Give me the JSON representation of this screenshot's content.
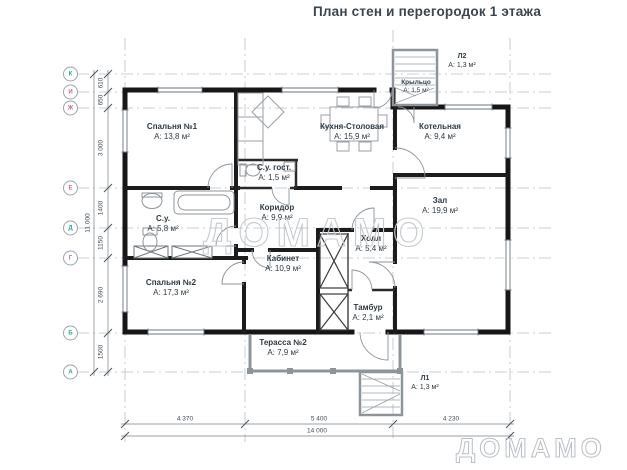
{
  "title": "План стен и перегородок 1 этажа",
  "watermark": {
    "center": "ДОМАМО",
    "corner": "ДОМАМО"
  },
  "rooms": {
    "bedroom1": {
      "name": "Спальня №1",
      "area": "А: 13,8 м²"
    },
    "kitchen": {
      "name": "Кухня-Столовая",
      "area": "А: 15,9 м²"
    },
    "boiler": {
      "name": "Котельная",
      "area": "А: 9,4 м²"
    },
    "living": {
      "name": "Зал",
      "area": "А: 19,9 м²"
    },
    "guest_wc": {
      "name": "С.у. гост.",
      "area": "А: 1,5 м²"
    },
    "corridor": {
      "name": "Коридор",
      "area": "А: 9,9 м²"
    },
    "wc": {
      "name": "С.у.",
      "area": "А: 5,8 м²"
    },
    "cabinet": {
      "name": "Кабинет",
      "area": "А: 10,9 м²"
    },
    "hall": {
      "name": "Холл",
      "area": "А: 5,4 м²"
    },
    "bedroom2": {
      "name": "Спальня №2",
      "area": "А: 17,3 м²"
    },
    "tambour": {
      "name": "Тамбур",
      "area": "А: 2,1 м²"
    },
    "terrace": {
      "name": "Терасса №2",
      "area": "А: 7,9 м²"
    },
    "porch": {
      "name": "Крыльцо",
      "area": "А: 1,5 м²"
    },
    "stair_l2": {
      "name": "Л2",
      "area": "А: 1,3 м²"
    },
    "stair_l1": {
      "name": "Л1",
      "area": "А: 1,3 м²"
    }
  },
  "grid": {
    "letters": [
      "К",
      "И",
      "Ж",
      "Е",
      "Д",
      "Г",
      "Б",
      "А"
    ]
  },
  "dims": {
    "left": [
      "610",
      "650",
      "3 000",
      "1400",
      "1150",
      "2 690",
      "1500"
    ],
    "left_total": "11 000",
    "bottom": [
      "4 370",
      "5 400",
      "4 230"
    ],
    "bottom_total": "14 000"
  },
  "colors": {
    "wall": "#1a1a1a",
    "grid_line": "#b8c0c6",
    "axis_letter_teal": "#2aa39e",
    "axis_letter_pink": "#c2679c",
    "watermark": "#c6cbcf"
  }
}
